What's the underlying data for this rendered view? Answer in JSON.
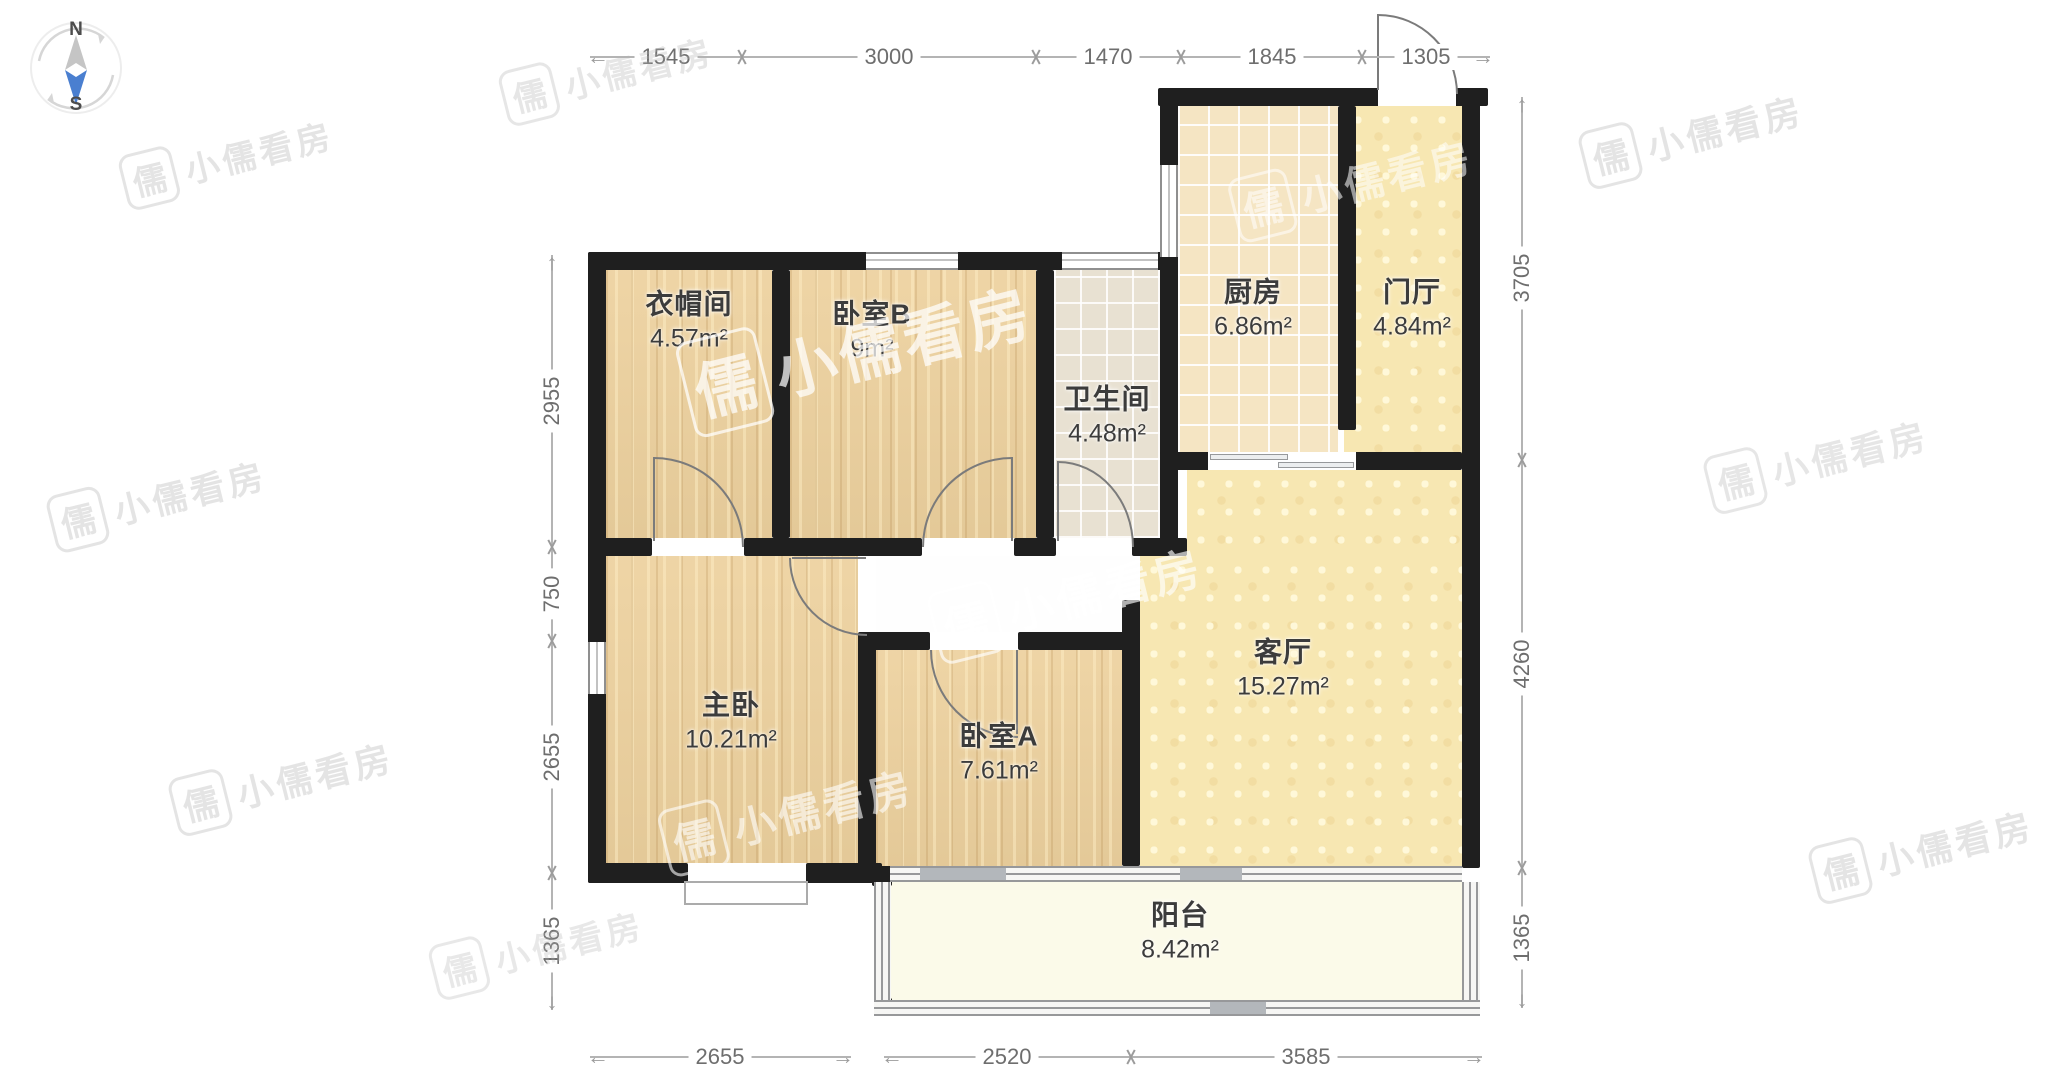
{
  "compass": {
    "north": "N",
    "south": "S"
  },
  "watermark": {
    "brand": "小儒看房",
    "icon": "儒"
  },
  "rooms": [
    {
      "name": "衣帽间",
      "area": "4.57m²"
    },
    {
      "name": "卧室B",
      "area": "9m²"
    },
    {
      "name": "卫生间",
      "area": "4.48m²"
    },
    {
      "name": "厨房",
      "area": "6.86m²"
    },
    {
      "name": "门厅",
      "area": "4.84m²"
    },
    {
      "name": "主卧",
      "area": "10.21m²"
    },
    {
      "name": "卧室A",
      "area": "7.61m²"
    },
    {
      "name": "客厅",
      "area": "15.27m²"
    },
    {
      "name": "阳台",
      "area": "8.42m²"
    }
  ],
  "dimensions": {
    "top": [
      "1545",
      "3000",
      "1470",
      "1845",
      "1305"
    ],
    "left": [
      "2955",
      "750",
      "2655",
      "1365"
    ],
    "right": [
      "3705",
      "4260",
      "1365"
    ],
    "bottom_left": [
      "2655"
    ],
    "bottom_right": [
      "2520",
      "3585"
    ]
  },
  "colors": {
    "wall": "#1f1f1f",
    "wood_floor": "#edd19e",
    "kitchen_tile": "#f5e5c3",
    "bath_tile": "#e8e1d2",
    "living_floor": "#f7e7b2",
    "balcony_floor": "#fbfae9",
    "compass_needle_blue": "#4a7fd0",
    "dimension_gray": "#9c9c9c"
  }
}
